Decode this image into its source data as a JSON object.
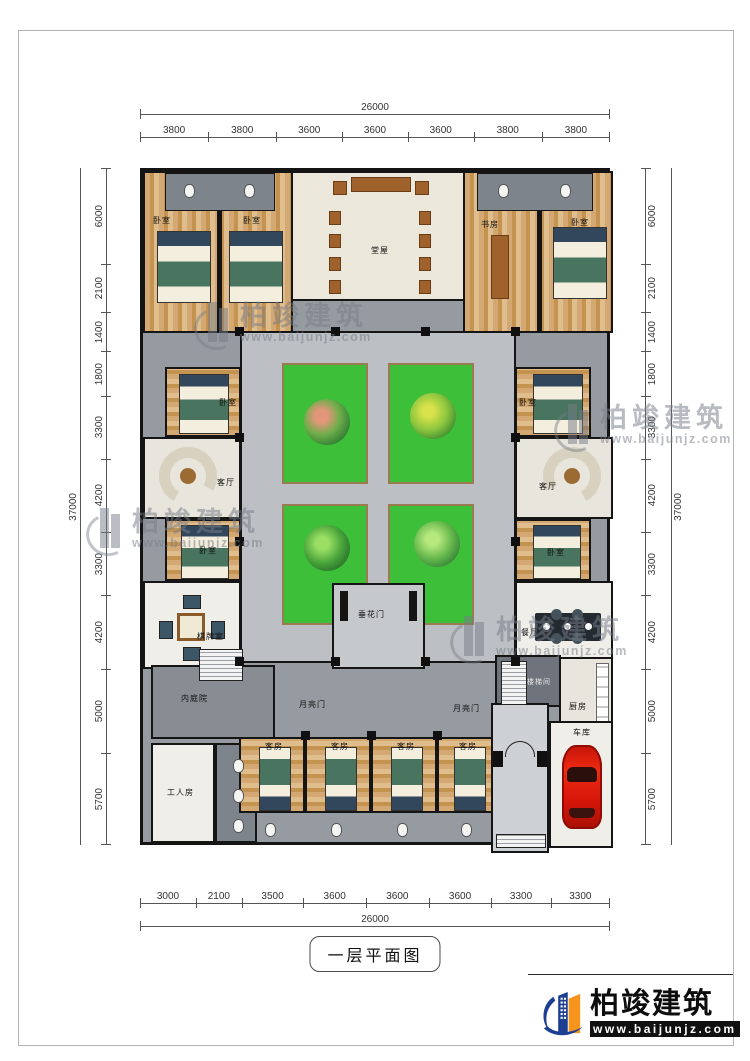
{
  "page": {
    "title": "一层平面图"
  },
  "dimensions": {
    "top": {
      "total": "26000",
      "segments": [
        "3800",
        "3800",
        "3600",
        "3600",
        "3600",
        "3800",
        "3800"
      ]
    },
    "bottom": {
      "total": "26000",
      "segments": [
        "3000",
        "2100",
        "3500",
        "3600",
        "3600",
        "3600",
        "3300",
        "3300"
      ]
    },
    "left": {
      "total": "37000",
      "segments": [
        "6000",
        "2100",
        "1400",
        "1800",
        "3300",
        "4200",
        "3300",
        "4200",
        "5000",
        "5700"
      ]
    },
    "right": {
      "total": "37000",
      "segments": [
        "6000",
        "2100",
        "1400",
        "1800",
        "3300",
        "4200",
        "3300",
        "4200",
        "5000",
        "5700"
      ]
    }
  },
  "rooms": {
    "bedroom_top_left_1": "卧室",
    "bedroom_top_left_2": "卧室",
    "main_hall": "堂屋",
    "study": "书房",
    "bedroom_top_right": "卧室",
    "bedroom_left_upper": "卧室",
    "living_left": "客厅",
    "bedroom_left_lower": "卧室",
    "chess_card_room": "棋牌室",
    "bedroom_right_upper": "卧室",
    "living_right": "客厅",
    "bedroom_right_lower": "卧室",
    "dining_room": "餐厅",
    "flower_gate": "垂花门",
    "inner_courtyard": "内庭院",
    "moon_gate_left": "月亮门",
    "moon_gate_right": "月亮门",
    "stairwell": "楼梯间",
    "kitchen": "厨房",
    "worker_room": "工人房",
    "guest_room_1": "客房",
    "guest_room_2": "客房",
    "guest_room_3": "客房",
    "guest_room_4": "客房",
    "garage": "车库"
  },
  "watermark": {
    "brand": "柏竣建筑",
    "url": "www.baijunjz.com"
  },
  "logo": {
    "brand": "柏竣建筑",
    "url": "www.baijunjz.com"
  },
  "colors": {
    "wall": "#141414",
    "corridor": "#969ba1",
    "walkway": "#bcc0c4",
    "lawn": "#3dbf3a",
    "wood_floor": "#cfa26b",
    "hall_floor": "#ebe7db",
    "car": "#e11b0f",
    "logo_blue": "#1c3f94",
    "logo_orange": "#f7941d"
  }
}
